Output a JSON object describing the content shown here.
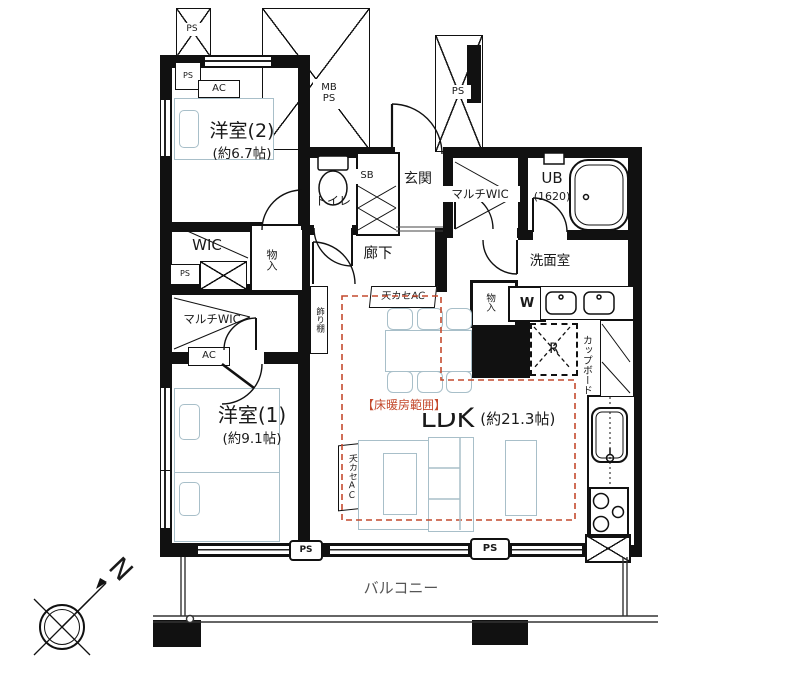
{
  "colors": {
    "wall": "#111111",
    "furniture_line": "#a8bfc9",
    "floor_heating_line": "#c44a2e",
    "text": "#1a1a1a",
    "balcony_text": "#555555"
  },
  "rooms": {
    "western2": {
      "name": "洋室(2)",
      "size": "(約6.7帖)"
    },
    "western1": {
      "name": "洋室(1)",
      "size": "(約9.1帖)"
    },
    "ldk": {
      "name": "LDK",
      "size": "(約21.3帖)"
    },
    "hallway": "廊下",
    "entrance": "玄関",
    "toilet": "トイレ",
    "washroom": "洗面室",
    "wic": "WIC",
    "multi_wic": "マルチWIC",
    "unit_bath": {
      "name": "UB",
      "size": "(1620)"
    },
    "storage": "物入",
    "balcony": "バルコニー"
  },
  "fixtures": {
    "shoe_box": "SB",
    "meter_box": "MB",
    "pipe_space": "PS",
    "cupboard": "カップボード",
    "display_shelf": "飾り棚",
    "washer": "W",
    "refrigerator": "R",
    "ceiling_ac": "天カセAC",
    "wall_ac": "AC",
    "floor_heating_label": "【床暖房範囲】",
    "north": "N"
  }
}
